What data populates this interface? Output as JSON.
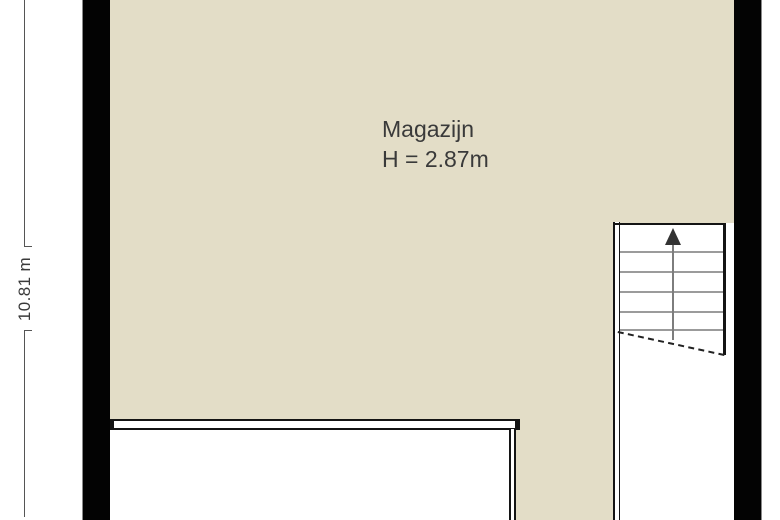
{
  "floor_plan": {
    "room_label": "Magazijn",
    "room_height_label": "H = 2.87m",
    "vertical_dimension_label": "10.81 m",
    "stairs": {
      "direction": "up",
      "icon": "up-arrow-icon"
    },
    "colors": {
      "floor_fill": "#e3ddc7",
      "wall_fill": "#030303",
      "wall_outline": "#8a8a8a",
      "interior_line": "#141414",
      "stair_tread": "#9b9b9b",
      "dimension_line": "#555555",
      "label_text": "#3a3a3a"
    }
  }
}
